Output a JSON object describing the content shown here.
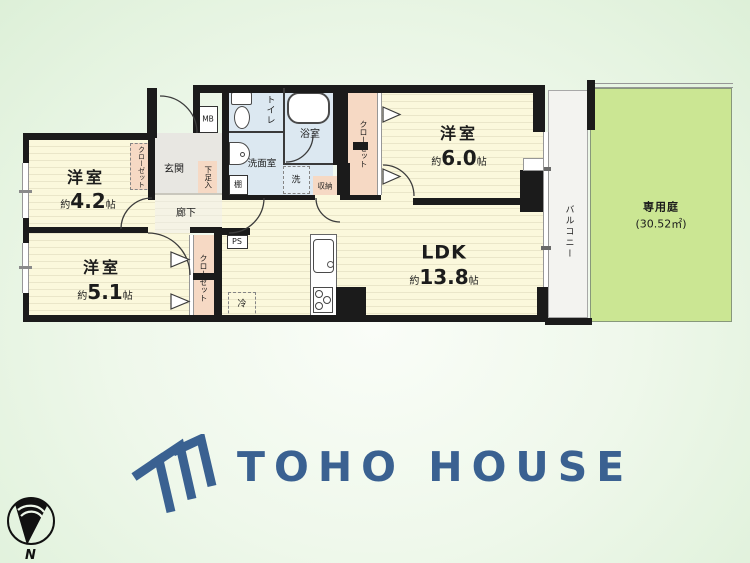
{
  "floorplan": {
    "rooms": [
      {
        "name": "洋室",
        "size_prefix": "約",
        "size_value": "4.2",
        "size_unit": "帖"
      },
      {
        "name": "洋室",
        "size_prefix": "約",
        "size_value": "5.1",
        "size_unit": "帖"
      },
      {
        "name": "洋室",
        "size_prefix": "約",
        "size_value": "6.0",
        "size_unit": "帖"
      },
      {
        "name": "LDK",
        "size_prefix": "約",
        "size_value": "13.8",
        "size_unit": "帖"
      }
    ],
    "labels": {
      "entrance": "玄関",
      "hallway": "廊下",
      "toilet": "トイレ",
      "bathroom": "浴室",
      "washroom": "洗面室",
      "washer": "洗",
      "shelf": "棚",
      "storage": "収納",
      "closet": "クローゼット",
      "shoe_box": "下足入",
      "meter_box": "MB",
      "pipe_space": "PS",
      "refrigerator": "冷",
      "balcony": "バルコニー",
      "garden": "専用庭",
      "garden_area": "(30.52㎡)"
    },
    "compass": {
      "north_label": "N"
    }
  },
  "branding": {
    "logo_text": "TOHO HOUSE",
    "brand_color": "#3a6191"
  }
}
